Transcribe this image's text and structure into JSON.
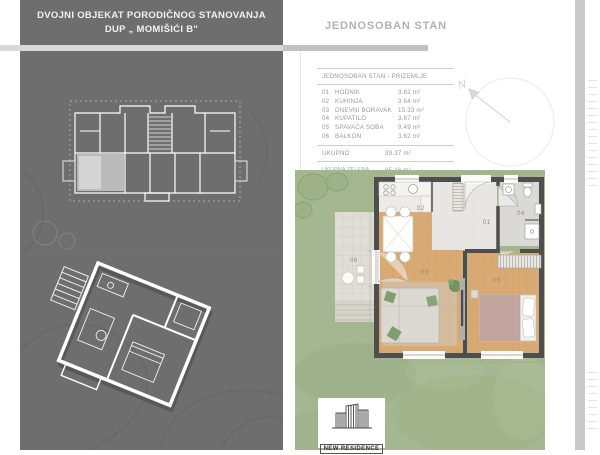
{
  "left_panel": {
    "title_line1": "DVOJNI OBJEKAT PORODIČNOG STANOVANJA",
    "title_line2": "DUP „ MOMIŠIĆI B\""
  },
  "right_panel": {
    "title": "JEDNOSOBAN STAN",
    "table": {
      "header": "JEDNOSOBAN STAN - PRIZEMLJE",
      "rows": [
        {
          "num": "01",
          "name": "HODNIK",
          "area": "3.62 m²"
        },
        {
          "num": "02",
          "name": "KUHINJA",
          "area": "3.64 m²"
        },
        {
          "num": "03",
          "name": "DNEVNI BORAVAK",
          "area": "15.33 m²"
        },
        {
          "num": "04",
          "name": "KUPATILO",
          "area": "3.67 m²"
        },
        {
          "num": "05",
          "name": "SPAVAĆA SOBA",
          "area": "9.49 m²"
        },
        {
          "num": "06",
          "name": "BALKON",
          "area": "3.62 m²"
        }
      ],
      "total_label": "UKUPNO",
      "total_area": "39.37 m²",
      "green_label": "UKUPNA ZELENA POVRŠINA",
      "green_area": "85.16 m²"
    },
    "north_letter": "N",
    "plan_labels": {
      "hodnik": "01",
      "kuhinja": "02",
      "dnevni": "03",
      "kupatilo": "04",
      "spavaca": "05",
      "balkon": "06"
    },
    "logo_text": "NEW RESIDENCE"
  },
  "colors": {
    "panel_gray": "#6e6e6e",
    "accent_green": "#7abf8e",
    "grass": "#a5b791",
    "wood_floor": "#d9aa74",
    "wall": "#4e4e4e"
  }
}
